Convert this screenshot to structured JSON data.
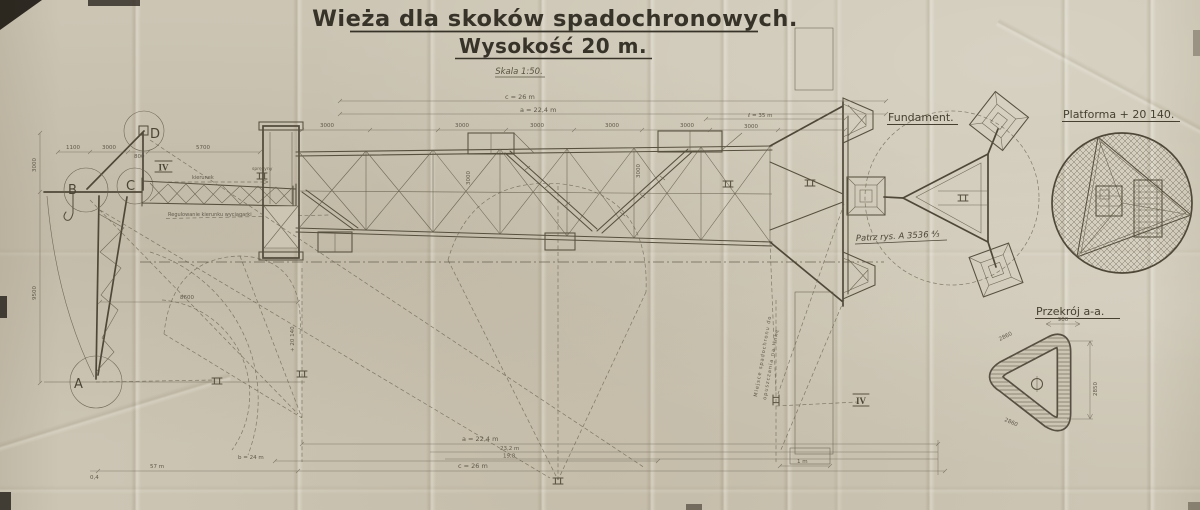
{
  "title": {
    "line1": "Wieża dla skoków spadochronowych.",
    "line2": "Wysokość 20 m.",
    "scale": "Skala 1:50."
  },
  "views": {
    "fundament": {
      "label": "Fundament.",
      "note": "Patrz rys. A 3536 ⁴⁄₃"
    },
    "platforma": {
      "label": "Platforma + 20 140."
    },
    "przekroj": {
      "label": "Przekrój a-a.",
      "dim_top": "900",
      "dim_right": "2850",
      "dim_left": "2860",
      "dim_bottom": "2860"
    }
  },
  "elev": {
    "markers": {
      "a": "A",
      "b": "B",
      "c": "C",
      "d": "D"
    },
    "roman": "IV",
    "notes": {
      "kierunek": "kierunek",
      "sprezyny": "sprężyny",
      "regulowanie": "Regulowanie kierunku wyciągarki",
      "rot1": "Miejsce spadochronu do",
      "rot2": "opuszczania na linkę",
      "platform_elev": "+ 20 140"
    },
    "dims": {
      "head1": "1100",
      "head2": "3000",
      "head3": "800",
      "head4": "5700",
      "bay": "3000",
      "len": "ℓ = 35 m",
      "c_top": "c = 26 m",
      "a_top": "a = 22,4 m",
      "a_bot": "a = 22,4 m",
      "d232": "23,2 m",
      "d198": "19,8",
      "c_bot": "c = 26 m",
      "d1m": "1 m",
      "d57": "57 m",
      "b24": "b = 24 m",
      "d04": "0,4",
      "d8600": "8600",
      "v_top": "3000",
      "v_bot": "9500"
    }
  },
  "colors": {
    "paper": "#ccc5b4",
    "ink": "#57503f",
    "ink_dark": "#373329"
  }
}
